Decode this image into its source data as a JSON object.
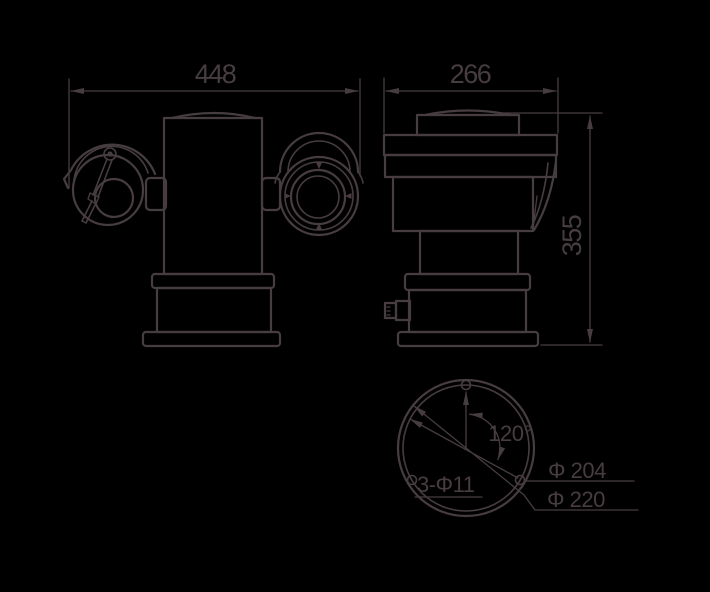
{
  "meta": {
    "type": "engineering-dimension-drawing",
    "background": "#000000",
    "line_color": "#473d41"
  },
  "labels": {
    "front_width": "448",
    "side_width": "266",
    "side_height": "355",
    "hole_angle": "120°",
    "hole_spec": "3-Φ11",
    "bolt_circle_diameter": "Φ 204",
    "flange_diameter": "Φ 220"
  }
}
